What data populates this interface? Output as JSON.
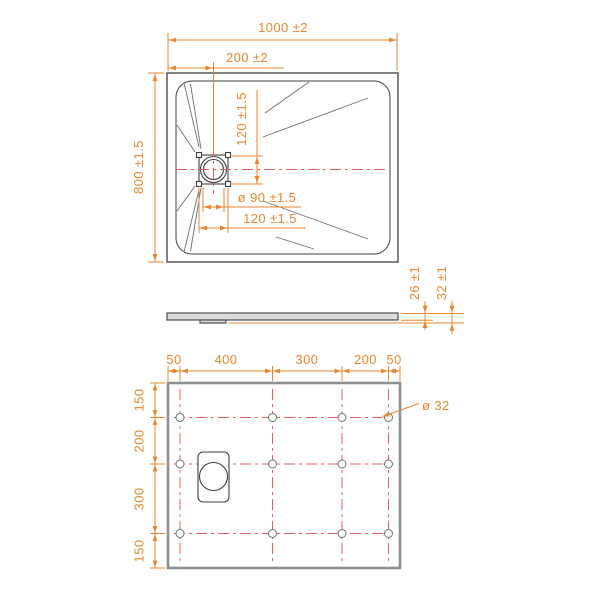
{
  "top_view": {
    "overall_width": "1000 ±2",
    "drain_offset_x": "200 ±2",
    "overall_depth": "800 ±1.5",
    "drain_square_height": "120 ±1.5",
    "drain_hole_diameter": "ø 90 ±1.5",
    "drain_square_width": "120 ±1.5"
  },
  "side_view": {
    "edge_thickness": "26 ±1",
    "total_thickness": "32 ±1"
  },
  "bottom_view": {
    "horizontal_dims": [
      "50",
      "400",
      "300",
      "200",
      "50"
    ],
    "vertical_dims": [
      "150",
      "200",
      "300",
      "150"
    ],
    "foot_hole_diameter": "ø 32"
  },
  "colors": {
    "dimension": "#E8862D",
    "centerline": "#E06060",
    "outline": "#3F3F3F",
    "wall_gray": "#8F8F8F"
  }
}
